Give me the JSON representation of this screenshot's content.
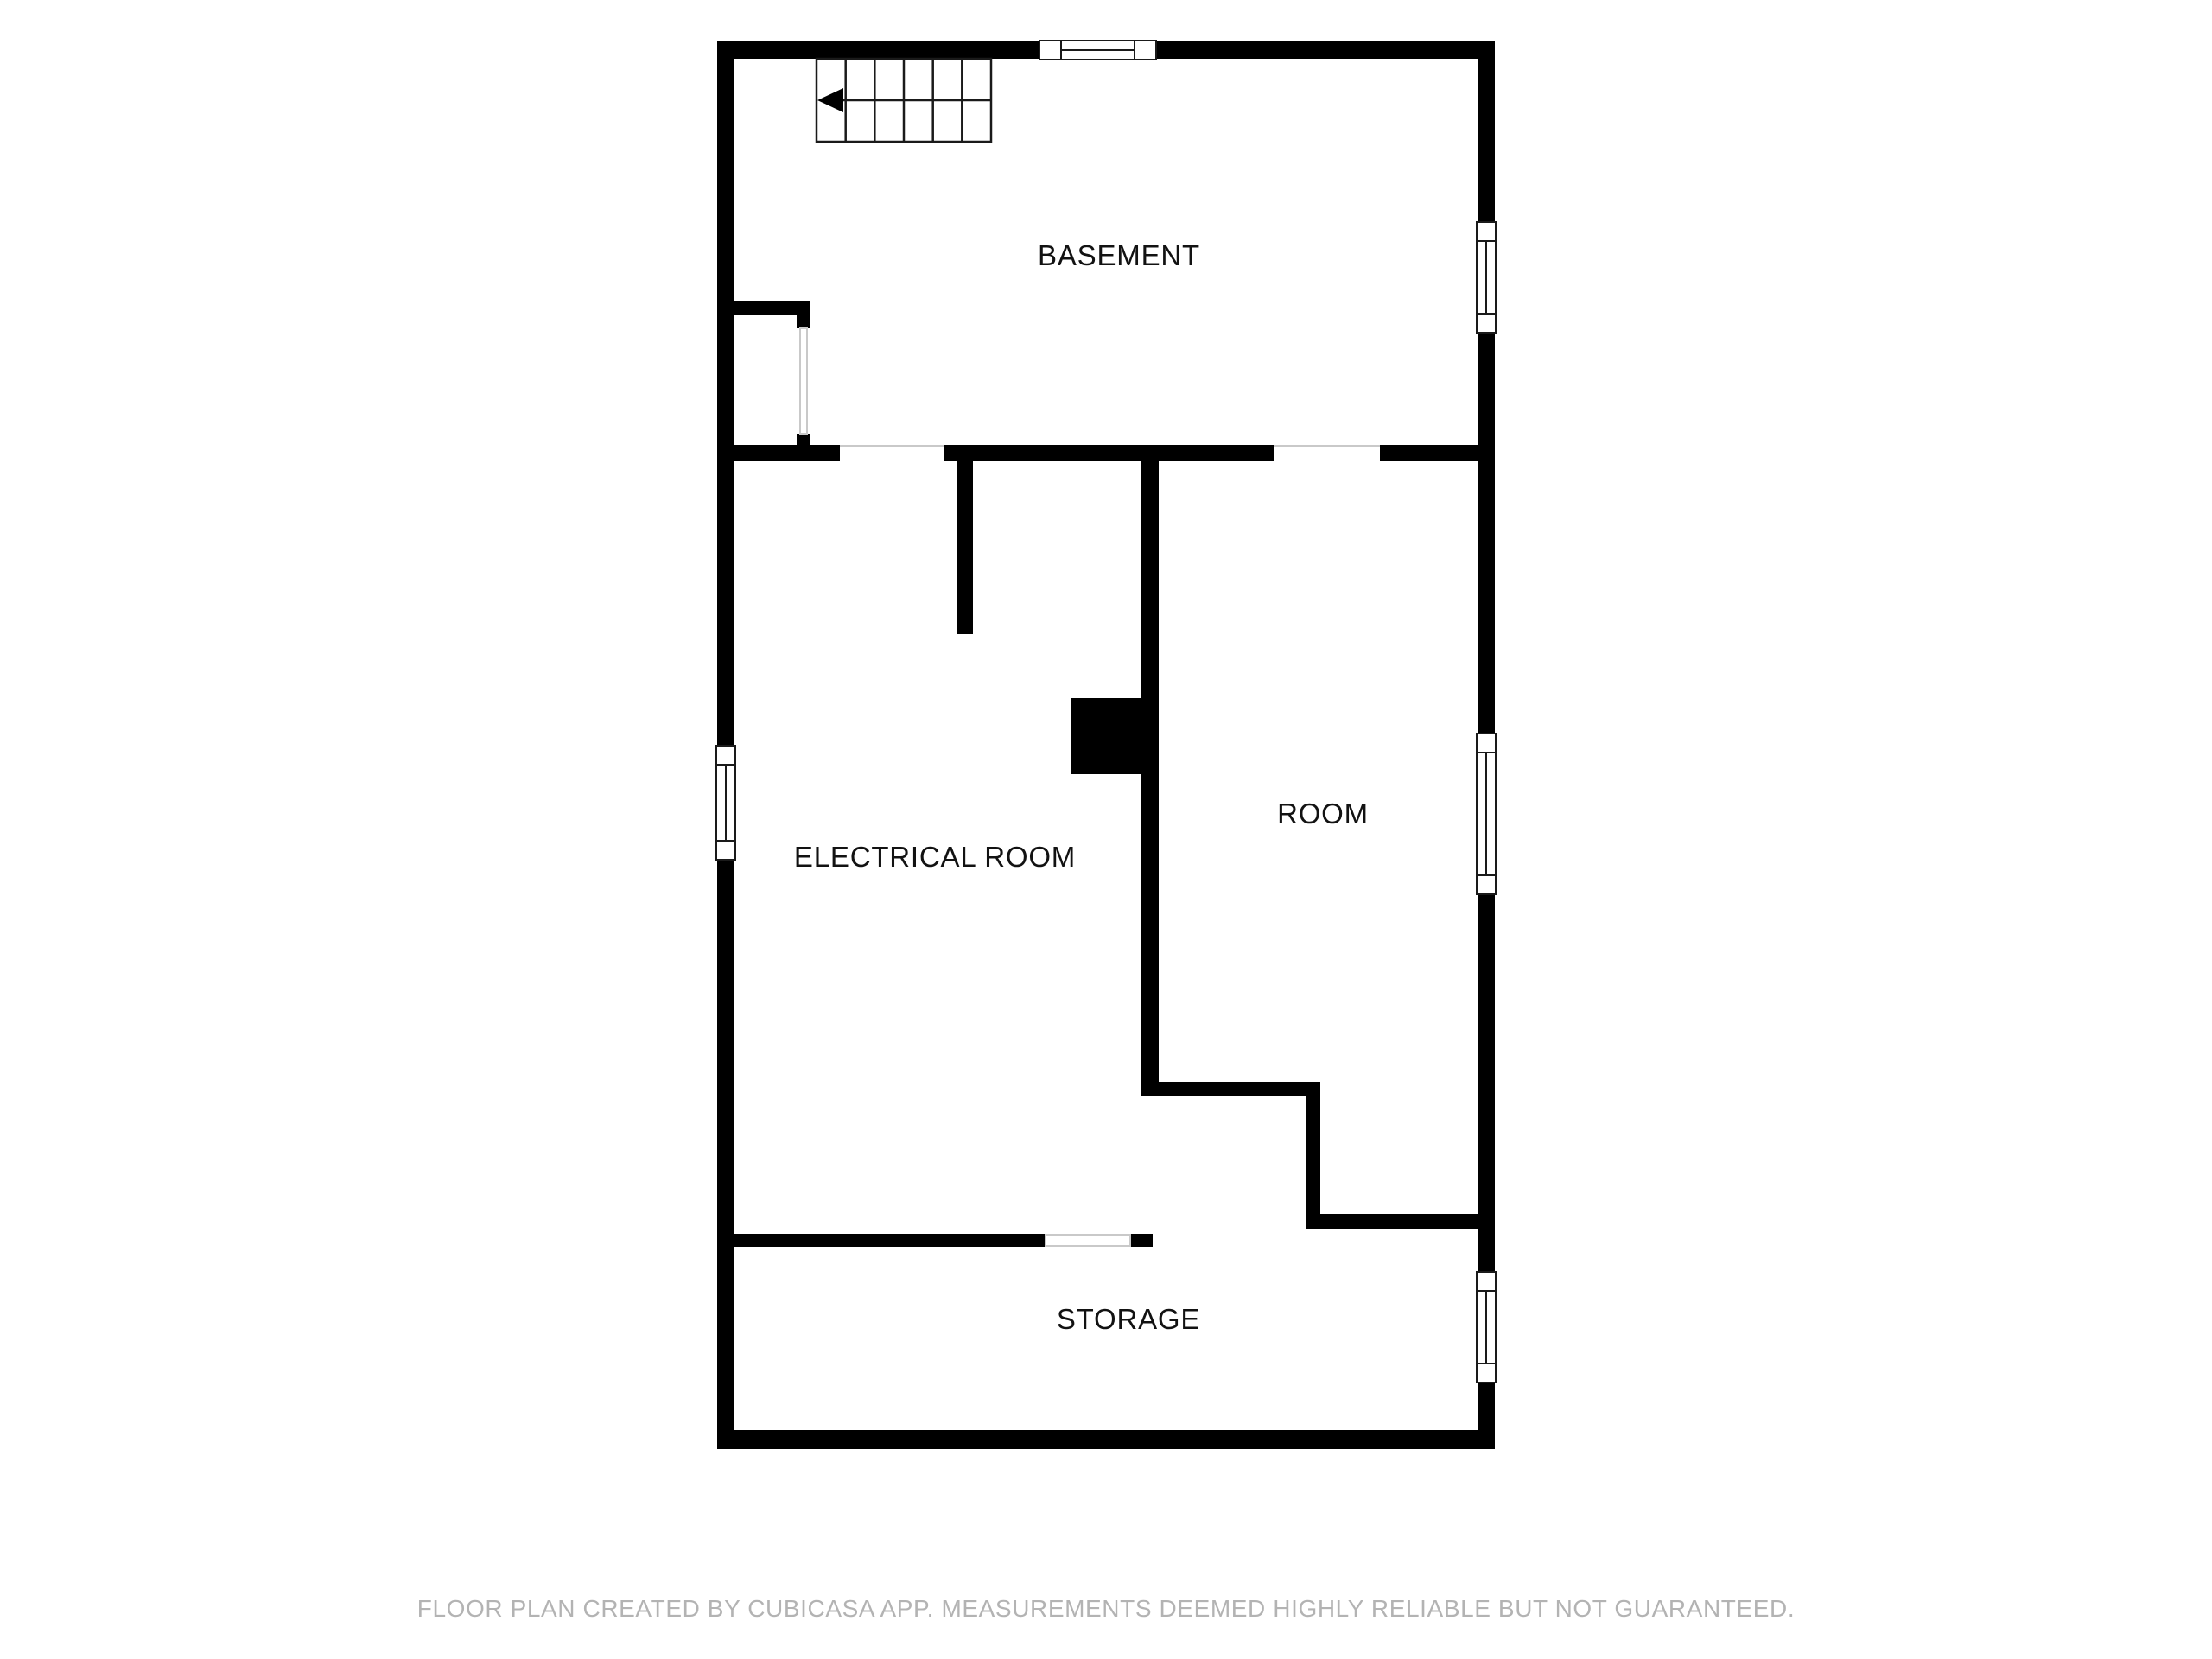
{
  "floor_plan": {
    "rooms": {
      "basement": {
        "label": "BASEMENT"
      },
      "electrical": {
        "label": "ELECTRICAL ROOM"
      },
      "room": {
        "label": "ROOM"
      },
      "storage": {
        "label": "STORAGE"
      }
    },
    "footer": {
      "disclaimer": "FLOOR PLAN CREATED BY CUBICASA APP. MEASUREMENTS DEEMED HIGHLY RELIABLE BUT NOT GUARANTEED."
    },
    "icons": {
      "stair_direction": "arrow-left"
    },
    "colors": {
      "wall": "#000000",
      "background": "#ffffff",
      "window_frame": "#1a1a1a",
      "opening_line": "#c9c9c9",
      "footer_text": "#b3b3b3"
    }
  }
}
